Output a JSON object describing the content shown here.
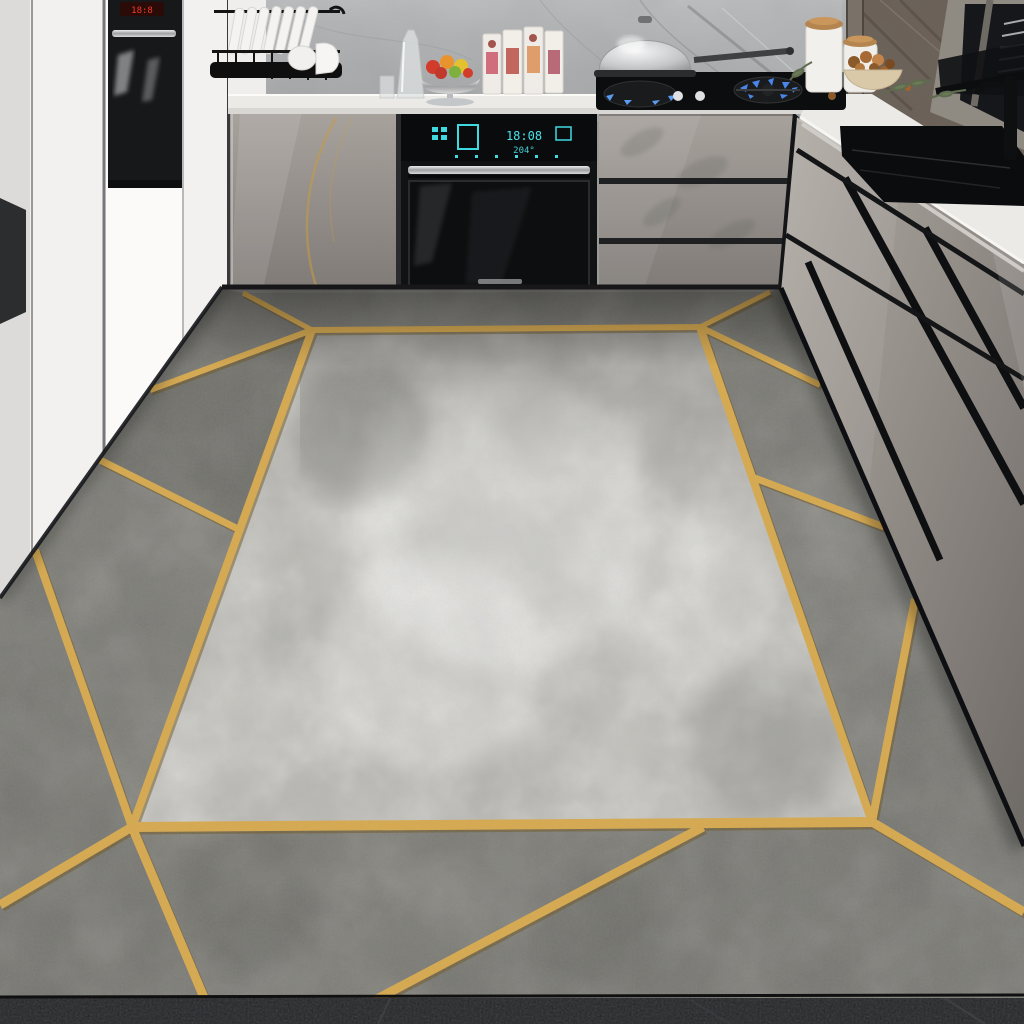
{
  "scene": {
    "setting": "modern L-shaped kitchen with gray gloss cabinets and marble backsplash",
    "floor_item": "gray concrete-texture area rug with gold geometric line pattern",
    "objects": [
      "dish-rack-with-plates",
      "glass-carafe",
      "fruit-stand",
      "juice-cartons",
      "built-in-wall-oven",
      "tall-built-in-oven",
      "gas-cooktop",
      "steel-wok-with-lid",
      "storage-canisters",
      "nut-bowl",
      "olive-branch",
      "black-sink",
      "black-faucet",
      "window-with-blinds",
      "marble-backsplash",
      "white-tall-cabinets",
      "gray-gloss-base-cabinets",
      "gold-trim-rug",
      "dark-tile-floor"
    ]
  },
  "appliances": {
    "wall_oven_display_time": "18:08",
    "wall_oven_display_temp": "204°",
    "tall_oven_display": "18:8"
  },
  "colors": {
    "gold": "#d7a94e",
    "gold_shadow": "#6f5620",
    "rug_border": "#8f8e88",
    "rug_inner": "#c7c6c1",
    "rug_dark_patch": "#4e4e4a",
    "floor_dark": "#26272a",
    "cabinet_taupe": "#99938e",
    "counter_white": "#eceae6",
    "white_cabinet": "#f2f1ef",
    "oven_black": "#111214",
    "sink_black": "#0b0c0d",
    "display_cyan": "#4be2ea",
    "display_red": "#f23b28",
    "flame_blue": "#4a86e8",
    "wood_lid": "#b5854f",
    "backsplash_gray": "#b3b5b7",
    "wall_marble_brown": "#6b6158"
  }
}
